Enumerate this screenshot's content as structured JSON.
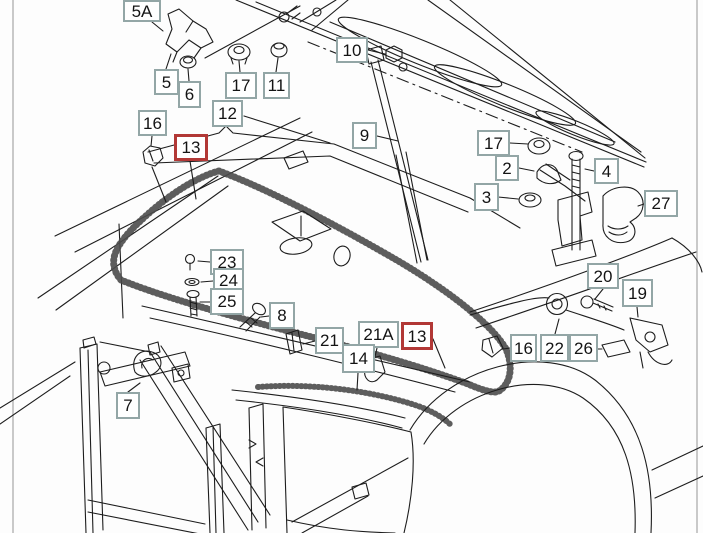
{
  "diagram": {
    "type": "exploded-parts-diagram",
    "subject": "hood-front-assembly",
    "colors": {
      "callout_border": "#93a6a6",
      "highlight_border": "#b23836",
      "line": "#1d1d1d",
      "background": "#fdfdfd"
    },
    "callouts": [
      {
        "label": "5A",
        "x": 123,
        "y": 0,
        "w": 38,
        "h": 22,
        "highlighted": false
      },
      {
        "label": "5",
        "x": 154,
        "y": 69,
        "w": 25,
        "h": 26,
        "highlighted": false
      },
      {
        "label": "6",
        "x": 178,
        "y": 81,
        "w": 23,
        "h": 27,
        "highlighted": false
      },
      {
        "label": "17",
        "x": 225,
        "y": 72,
        "w": 32,
        "h": 27,
        "highlighted": false
      },
      {
        "label": "11",
        "x": 263,
        "y": 72,
        "w": 27,
        "h": 27,
        "highlighted": false
      },
      {
        "label": "12",
        "x": 212,
        "y": 100,
        "w": 31,
        "h": 27,
        "highlighted": false
      },
      {
        "label": "16",
        "x": 138,
        "y": 110,
        "w": 29,
        "h": 26,
        "highlighted": false
      },
      {
        "label": "13",
        "x": 174,
        "y": 134,
        "w": 34,
        "h": 27,
        "highlighted": true
      },
      {
        "label": "10",
        "x": 336,
        "y": 37,
        "w": 32,
        "h": 26,
        "highlighted": false
      },
      {
        "label": "9",
        "x": 352,
        "y": 122,
        "w": 25,
        "h": 27,
        "highlighted": false
      },
      {
        "label": "17",
        "x": 477,
        "y": 130,
        "w": 33,
        "h": 26,
        "highlighted": false
      },
      {
        "label": "2",
        "x": 495,
        "y": 155,
        "w": 24,
        "h": 26,
        "highlighted": false
      },
      {
        "label": "3",
        "x": 474,
        "y": 183,
        "w": 25,
        "h": 28,
        "highlighted": false
      },
      {
        "label": "4",
        "x": 594,
        "y": 158,
        "w": 25,
        "h": 26,
        "highlighted": false
      },
      {
        "label": "27",
        "x": 644,
        "y": 190,
        "w": 34,
        "h": 27,
        "highlighted": false
      },
      {
        "label": "23",
        "x": 210,
        "y": 249,
        "w": 34,
        "h": 26,
        "highlighted": false
      },
      {
        "label": "24",
        "x": 213,
        "y": 268,
        "w": 31,
        "h": 24,
        "highlighted": false
      },
      {
        "label": "25",
        "x": 210,
        "y": 288,
        "w": 34,
        "h": 27,
        "highlighted": false
      },
      {
        "label": "8",
        "x": 269,
        "y": 302,
        "w": 26,
        "h": 27,
        "highlighted": false
      },
      {
        "label": "21",
        "x": 315,
        "y": 327,
        "w": 29,
        "h": 27,
        "highlighted": false
      },
      {
        "label": "21A",
        "x": 358,
        "y": 321,
        "w": 41,
        "h": 27,
        "highlighted": false
      },
      {
        "label": "13",
        "x": 401,
        "y": 322,
        "w": 32,
        "h": 28,
        "highlighted": true
      },
      {
        "label": "14",
        "x": 342,
        "y": 344,
        "w": 33,
        "h": 29,
        "highlighted": false
      },
      {
        "label": "20",
        "x": 587,
        "y": 263,
        "w": 32,
        "h": 26,
        "highlighted": false
      },
      {
        "label": "19",
        "x": 622,
        "y": 279,
        "w": 31,
        "h": 28,
        "highlighted": false
      },
      {
        "label": "16",
        "x": 510,
        "y": 334,
        "w": 27,
        "h": 28,
        "highlighted": false
      },
      {
        "label": "22",
        "x": 540,
        "y": 334,
        "w": 29,
        "h": 28,
        "highlighted": false
      },
      {
        "label": "26",
        "x": 569,
        "y": 334,
        "w": 29,
        "h": 28,
        "highlighted": false
      },
      {
        "label": "7",
        "x": 116,
        "y": 392,
        "w": 24,
        "h": 27,
        "highlighted": false
      }
    ]
  }
}
